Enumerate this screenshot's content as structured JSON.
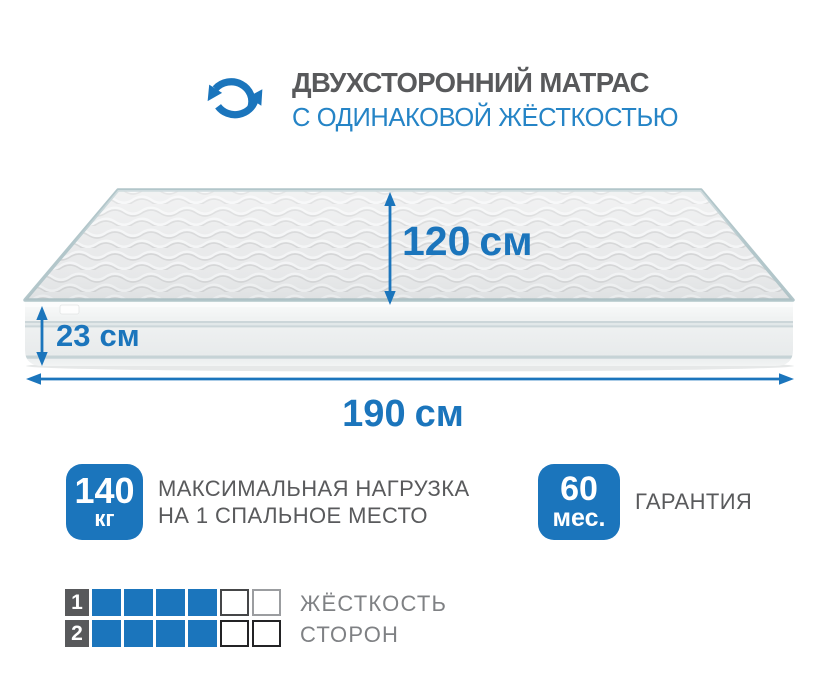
{
  "header": {
    "title": "ДВУХСТОРОННИЙ МАТРАС",
    "subtitle": "С ОДИНАКОВОЙ ЖЁСТКОСТЬЮ"
  },
  "icons": {
    "header_icon": "rotate-sync-arrows"
  },
  "dimensions": {
    "depth": {
      "value": "120",
      "unit": "см"
    },
    "height": {
      "value": "23",
      "unit": "см"
    },
    "length": {
      "value": "190",
      "unit": "см"
    }
  },
  "features": [
    {
      "id": "max-load",
      "value": "140",
      "unit": "кг",
      "lines": [
        "МАКСИМАЛЬНАЯ НАГРУЗКА",
        "НА 1 СПАЛЬНОЕ МЕСТО"
      ]
    },
    {
      "id": "warranty",
      "value": "60",
      "unit": "мес.",
      "lines": [
        "ГАРАНТИЯ"
      ]
    }
  ],
  "firmness": {
    "label_lines": [
      "ЖЁСТКОСТЬ",
      "СТОРОН"
    ],
    "scale_max": 6,
    "rows": [
      {
        "side": "1",
        "rating": 4
      },
      {
        "side": "2",
        "rating": 4
      }
    ]
  },
  "colors": {
    "accent_blue": "#1b75bc",
    "subtitle_blue": "#2584c6",
    "title_gray": "#58595b",
    "feature_text_gray": "#595a5c",
    "firmness_text_gray": "#7f8184",
    "grid_number_bg": "#58595b",
    "mattress_piping": "#b2c6ca"
  }
}
